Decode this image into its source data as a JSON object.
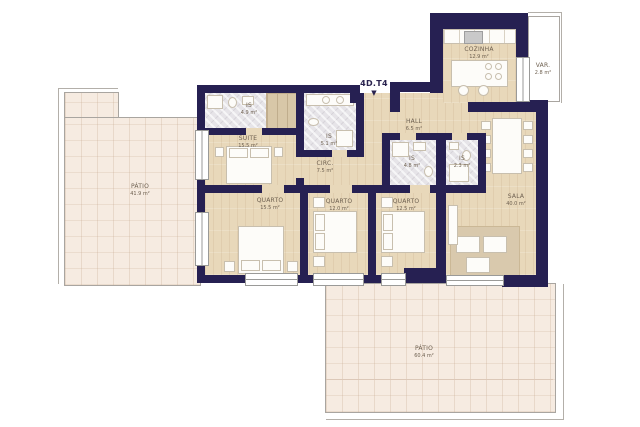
{
  "unit": {
    "label": "4D.T4",
    "arrow": "▼"
  },
  "rooms": {
    "patio_left": {
      "name": "PÁTIO",
      "area": "41.9 m²"
    },
    "suite": {
      "name": "SUITE",
      "area": "15.5 m²"
    },
    "is_suite": {
      "name": "IS",
      "area": "4.9 m²"
    },
    "is_mid": {
      "name": "IS",
      "area": "5.1 m²"
    },
    "circ": {
      "name": "CIRC.",
      "area": "7.5 m²"
    },
    "hall": {
      "name": "HALL",
      "area": "6.5 m²"
    },
    "cozinha": {
      "name": "COZINHA",
      "area": "12.9 m²"
    },
    "varanda": {
      "name": "VAR.",
      "area": "2.8 m²"
    },
    "is_hall": {
      "name": "IS",
      "area": "4.8 m²"
    },
    "is_social": {
      "name": "IS",
      "area": "2.3 m²"
    },
    "quarto1": {
      "name": "QUARTO",
      "area": "15.5 m²"
    },
    "quarto2": {
      "name": "QUARTO",
      "area": "12.0 m²"
    },
    "quarto3": {
      "name": "QUARTO",
      "area": "12.5 m²"
    },
    "sala": {
      "name": "SALA",
      "area": "40.0 m²"
    },
    "patio_bottom": {
      "name": "PÁTIO",
      "area": "60.4 m²"
    }
  },
  "colors": {
    "wall": "#262052",
    "wood": "#e8d8ba",
    "patio": "#f6ebe1",
    "marble": "#e6e4e8"
  }
}
